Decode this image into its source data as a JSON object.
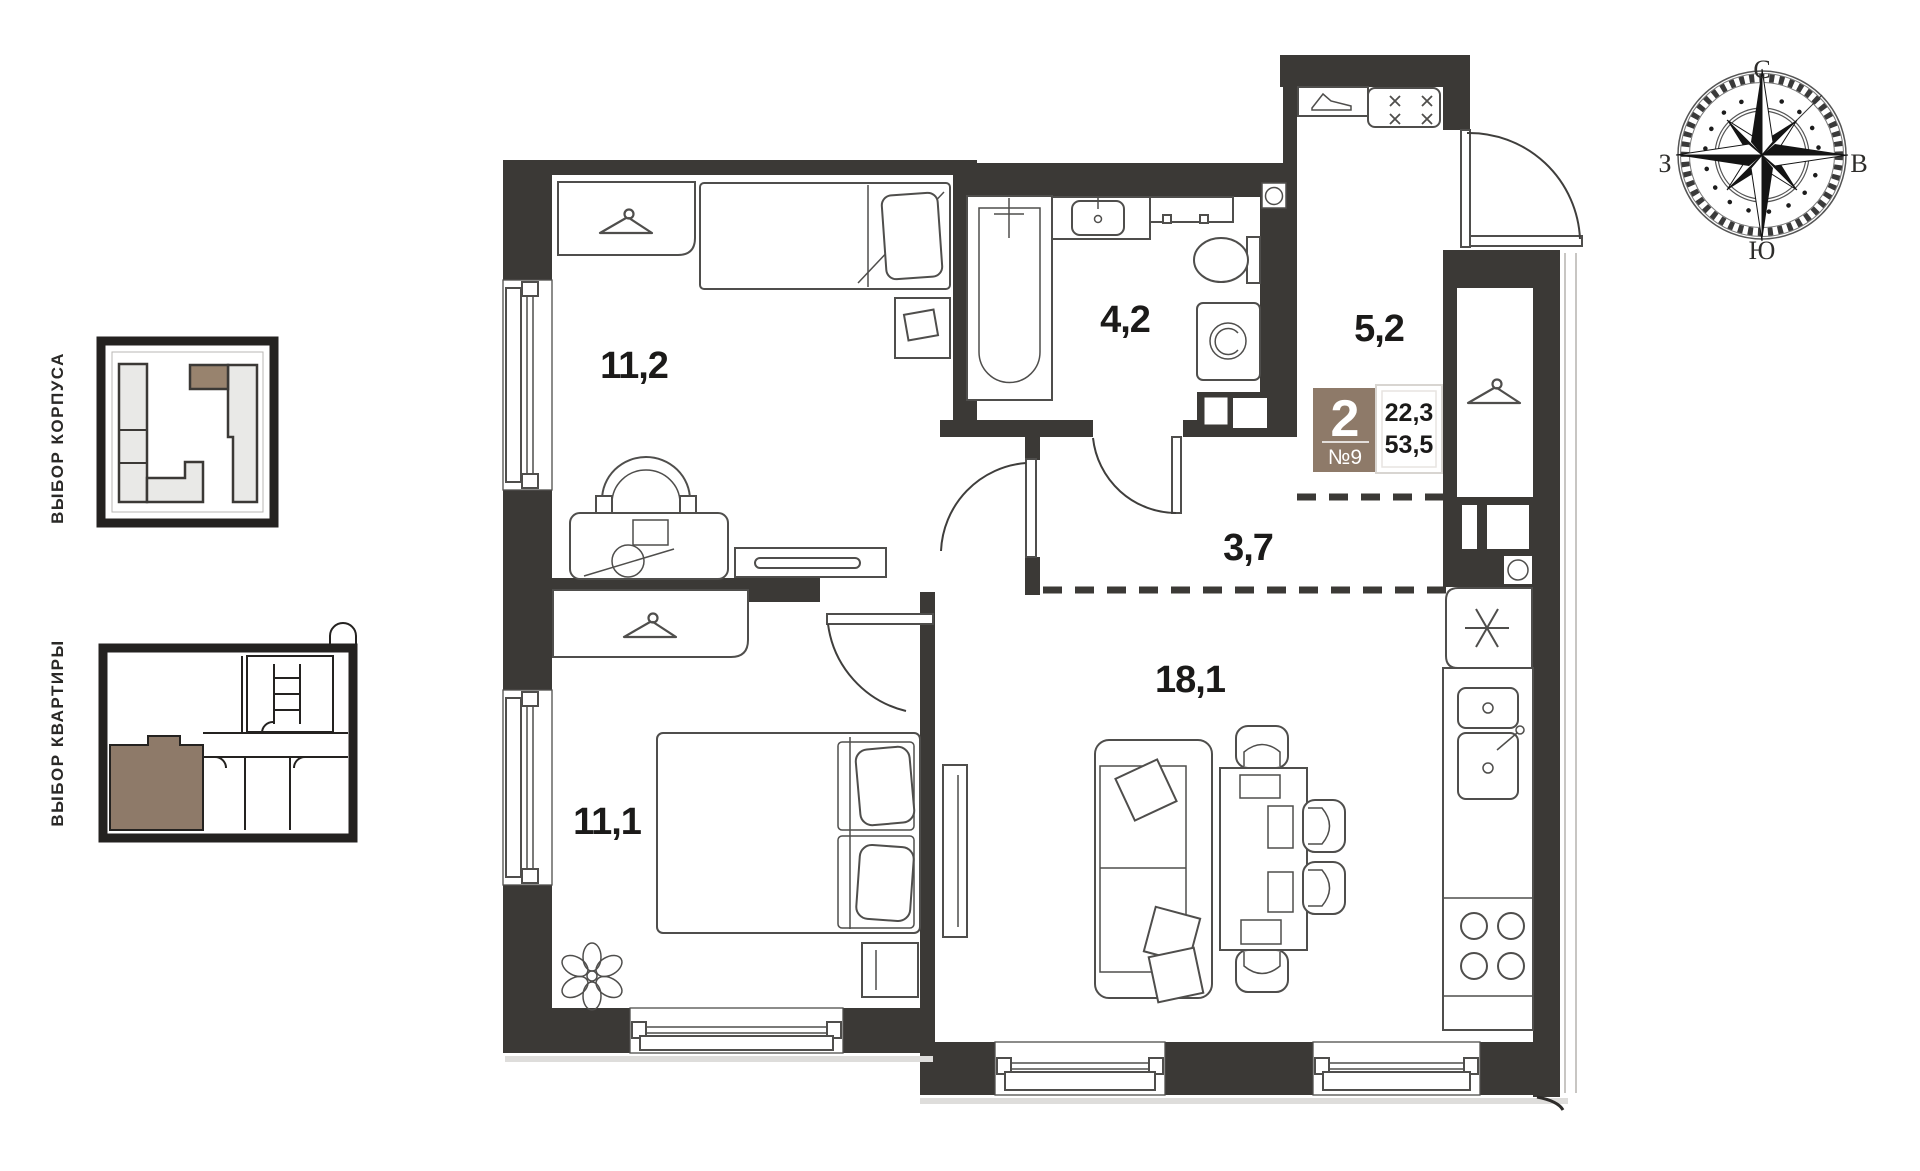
{
  "sidebar": {
    "building_selector_label": "ВЫБОР КОРПУСА",
    "apartment_selector_label": "ВЫБОР КВАРТИРЫ"
  },
  "plan": {
    "rooms": [
      {
        "name": "bedroom-top",
        "area": "11,2"
      },
      {
        "name": "bathroom",
        "area": "4,2"
      },
      {
        "name": "entry-hall",
        "area": "5,2"
      },
      {
        "name": "hallway",
        "area": "3,7"
      },
      {
        "name": "living-kitchen",
        "area": "18,1"
      },
      {
        "name": "bedroom-bottom",
        "area": "11,1"
      }
    ],
    "badge": {
      "rooms_count": "2",
      "apartment_number": "№9",
      "area_living": "22,3",
      "area_total": "53,5"
    },
    "compass": {
      "north": "С",
      "east": "В",
      "south": "Ю",
      "west": "З"
    },
    "colors": {
      "accent": "#8E7A69",
      "wall": "#3B3936"
    }
  }
}
